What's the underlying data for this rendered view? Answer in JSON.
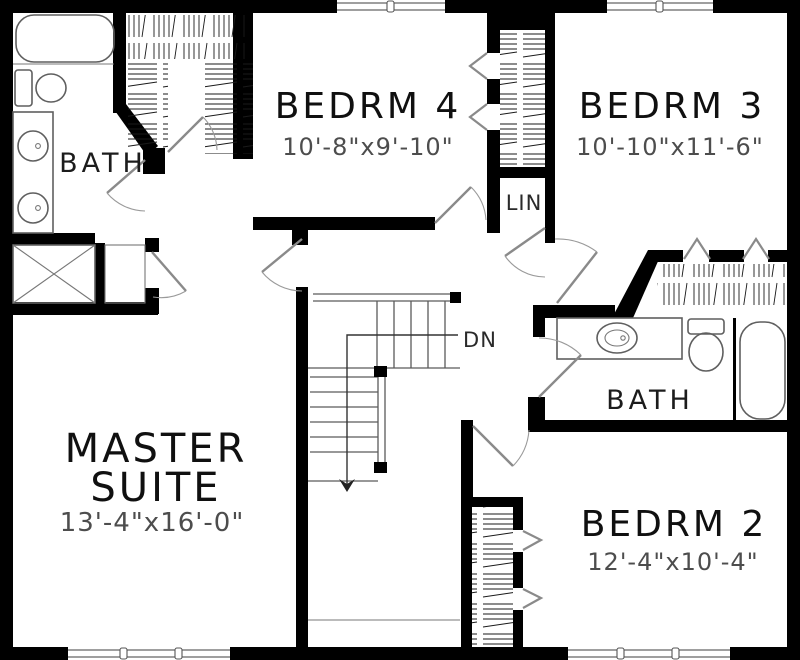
{
  "colors": {
    "wall": "#000000",
    "background": "#ffffff",
    "fixture_line": "#5f5f5f",
    "door_line": "#8a8a8a",
    "dimension_text": "#4d4d4d",
    "room_text": "#101010"
  },
  "rooms": {
    "bath_left": {
      "label": "BATH"
    },
    "bedrm4": {
      "label": "BEDRM 4",
      "dimensions": "10'-8\"x9'-10\""
    },
    "bedrm3": {
      "label": "BEDRM 3",
      "dimensions": "10'-10\"x11'-6\""
    },
    "linen": {
      "label": "LIN"
    },
    "stairs": {
      "label": "DN"
    },
    "master": {
      "label_line1": "MASTER",
      "label_line2": "SUITE",
      "dimensions": "13'-4\"x16'-0\""
    },
    "bath_right": {
      "label": "BATH"
    },
    "bedrm2": {
      "label": "BEDRM 2",
      "dimensions": "12'-4\"x10'-4\""
    }
  }
}
